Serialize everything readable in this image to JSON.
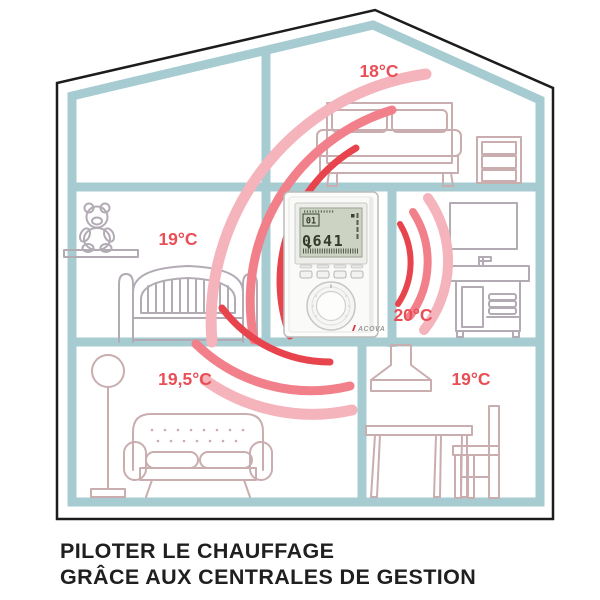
{
  "rooms": {
    "bedroom": {
      "name": "bedroom",
      "temperature": "18°C"
    },
    "kids_room": {
      "name": "kids-room",
      "temperature": "19°C"
    },
    "bathroom": {
      "name": "bathroom",
      "temperature": "20°C"
    },
    "living_room": {
      "name": "living-room",
      "temperature": "19,5°C"
    },
    "dining_room": {
      "name": "dining-room",
      "temperature": "19°C"
    }
  },
  "thermostat": {
    "brand": "ACOVA",
    "lcd": {
      "day": "01",
      "time": "0641"
    }
  },
  "caption": {
    "line1": "PILOTER LE CHAUFFAGE",
    "line2": "GRÂCE AUX CENTRALES DE GESTION"
  },
  "illustrations": [
    "double-bed",
    "dresser",
    "teddy-bear",
    "kids-bed",
    "mirror",
    "bathroom-vanity",
    "floor-lamp",
    "sofa",
    "extractor-hood",
    "dining-table",
    "dining-chair",
    "radio-waves-left",
    "radio-waves-right",
    "radio-waves-down"
  ],
  "colors": {
    "accent_red": "#e94f56",
    "wall_teal": "#a6cbd1",
    "outline_black": "#1c1c1c",
    "furniture_pink": "#c9adaf",
    "furniture_grey": "#b2abb4",
    "wave_light": "#f5b3bc",
    "wave_medium": "#f1808b",
    "wave_red": "#e8444d",
    "lcd_green": "#ccd3c3",
    "caption_black": "#1f1f1f"
  }
}
